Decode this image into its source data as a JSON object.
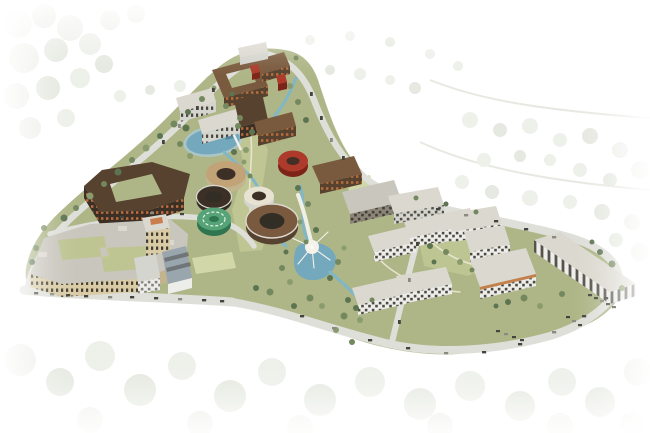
{
  "colors": {
    "backdrop_tree": "#e4e8de",
    "backdrop_tree_dark": "#d8ddd0",
    "site_green": "#aeb687",
    "lawn": "#c2c996",
    "lawn_pale": "#d2d7a8",
    "road": "#dfdfda",
    "water": "#74a9bd",
    "water_deep": "#54869c",
    "water_light": "#a9cbd6",
    "stream": "#7fb6c8",
    "path_cream": "#efe9d6",
    "plaza": "#f4f2e9",
    "roof": "#c9c6bd",
    "roof_light": "#dbd8cf",
    "roof_slate": "#9aa6ae",
    "wall_beige": "#d9cba6",
    "wall_beige_shade": "#c2b48d",
    "wall_tan": "#c2a277",
    "wall_brown": "#7a5a3e",
    "wall_brown_dark": "#57422f",
    "wall_dark": "#3c3026",
    "window_dark": "#322d25",
    "accent_orange": "#c9743e",
    "wall_red": "#ad3a2a",
    "wall_red_dark": "#7c2418",
    "wall_green": "#2e7550",
    "wall_green_light": "#56a377",
    "wall_cream": "#e8e2d2",
    "wall_white": "#ededea",
    "wall_white_shade": "#d5d5cf",
    "tree_dark": "#5d7450",
    "tree_mid": "#74885e",
    "tree_light": "#8a9c6e",
    "car_dark": "#46443d",
    "car_light": "#8a8a82"
  }
}
